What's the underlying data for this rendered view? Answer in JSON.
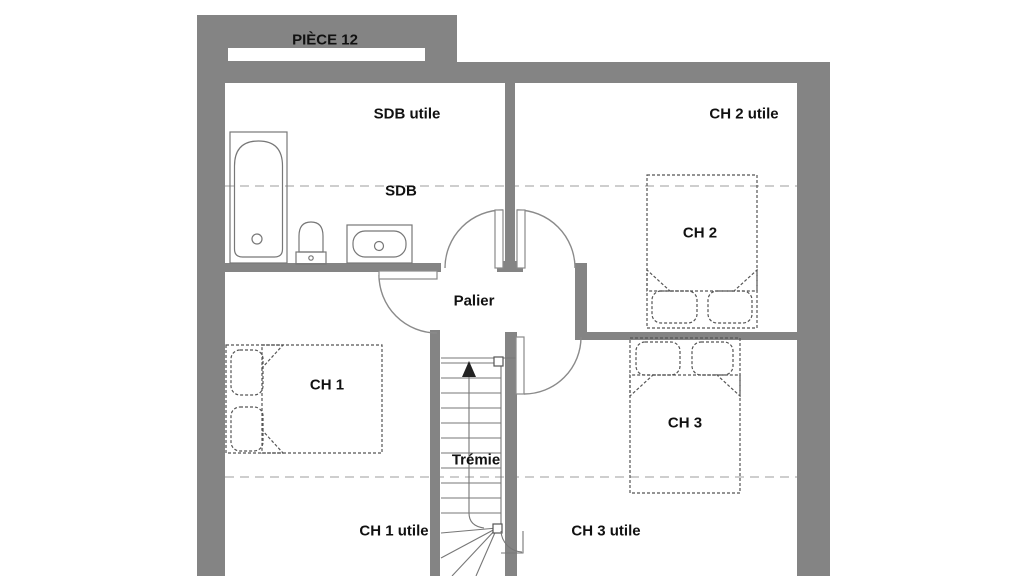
{
  "plan": {
    "type": "floor-plan",
    "floor": "étage (chambres)",
    "labels": {
      "piece12": "PIÈCE 12",
      "sdb_utile": "SDB utile",
      "ch2_utile": "CH 2 utile",
      "sdb": "SDB",
      "ch2": "CH 2",
      "palier": "Palier",
      "ch1": "CH 1",
      "ch3": "CH 3",
      "tremie": "Trémie",
      "ch1_utile": "CH 1 utile",
      "ch3_utile": "CH 3 utile"
    },
    "rooms": [
      "SDB",
      "CH 1",
      "CH 2",
      "CH 3",
      "Palier",
      "PIÈCE 12"
    ],
    "fixtures": [
      "bathtub",
      "toilet",
      "washbasin",
      "double-bed-ch1",
      "double-bed-ch2",
      "double-bed-ch3",
      "staircase-with-winders"
    ]
  },
  "colors": {
    "wall": "#848484",
    "line": "#777777",
    "dashed": "#bdbdbd",
    "bed": "#555555",
    "text": "#111111",
    "bg": "#ffffff"
  }
}
